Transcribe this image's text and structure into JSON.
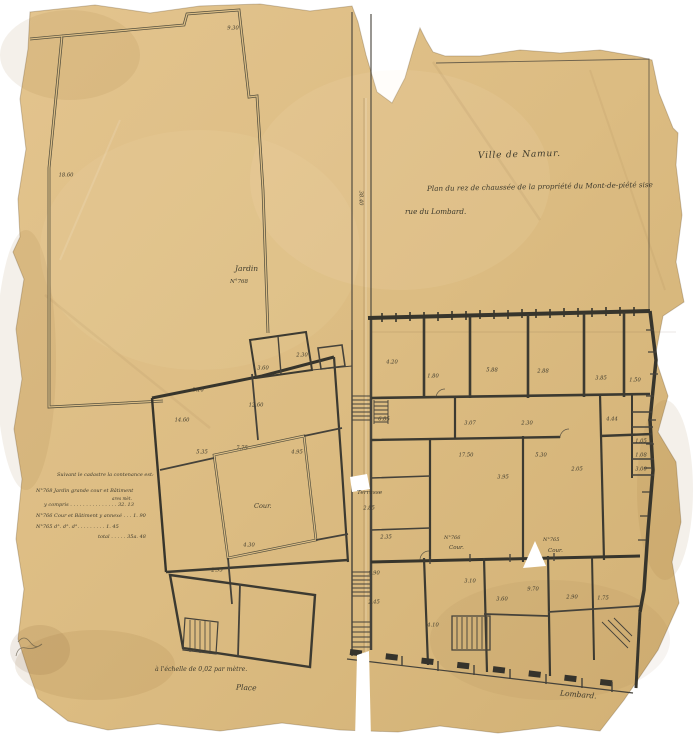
{
  "colors": {
    "paper": "#dcbe86",
    "paper_light": "#e3c48e",
    "paper_dark": "#d2b175",
    "ink": "#45423a",
    "wall": "#37352c",
    "tear_white": "#ffffff"
  },
  "title_block": {
    "line1": "Ville de Namur.",
    "line2": "Plan du rez de chaussée de la propriété du Mont-de-piété sise",
    "line3": "rue du Lombard."
  },
  "cadastre": {
    "heading": "Suivant le cadastre la contenance est:",
    "col_header": "ares mèt.",
    "rows": [
      "N°768 Jardin grande cour et Bâtiment",
      "y compris . . . . . . . . . . . . . . .   32. 13",
      "N°766 Cour et Bâtiment y annexé . . .   1. 90",
      "N°765  d°.   d°.   d°.  . . . . . . . .   1. 45"
    ],
    "total": "total . . . . .  35a. 48"
  },
  "labels": {
    "jardin": "Jardin",
    "jardin_no": "N°768",
    "terrasse": "Terrasse",
    "cour_left": "Cour.",
    "cour_766_no": "N°766",
    "cour_766": "Cour.",
    "cour_765_no": "N°765",
    "cour_765": "Cour.",
    "scale_note": "à l'échelle de 0,02 par mètre.",
    "street_place": "Place",
    "street_lombard": "Lombard."
  },
  "plan": {
    "dimensions": [
      {
        "x": 233,
        "y": 29,
        "t": "9.30"
      },
      {
        "x": 66,
        "y": 176,
        "t": "18.60"
      },
      {
        "x": 360,
        "y": 198,
        "t": "38.40",
        "r": 90
      },
      {
        "x": 392,
        "y": 363,
        "t": "4.20"
      },
      {
        "x": 433,
        "y": 377,
        "t": "1.80"
      },
      {
        "x": 492,
        "y": 371,
        "t": "5.88"
      },
      {
        "x": 543,
        "y": 372,
        "t": "2.88"
      },
      {
        "x": 601,
        "y": 379,
        "t": "3.85"
      },
      {
        "x": 635,
        "y": 381,
        "t": "1.50"
      },
      {
        "x": 470,
        "y": 424,
        "t": "3.07"
      },
      {
        "x": 527,
        "y": 424,
        "t": "2.30"
      },
      {
        "x": 612,
        "y": 420,
        "t": "4.44"
      },
      {
        "x": 641,
        "y": 442,
        "t": "1.05"
      },
      {
        "x": 641,
        "y": 456,
        "t": "1.08"
      },
      {
        "x": 641,
        "y": 470,
        "t": "3.00"
      },
      {
        "x": 466,
        "y": 456,
        "t": "17.50"
      },
      {
        "x": 541,
        "y": 456,
        "t": "5.30"
      },
      {
        "x": 503,
        "y": 478,
        "t": "3.95"
      },
      {
        "x": 577,
        "y": 470,
        "t": "2.05"
      },
      {
        "x": 384,
        "y": 420,
        "t": "6.85"
      },
      {
        "x": 369,
        "y": 509,
        "t": "2.85"
      },
      {
        "x": 386,
        "y": 538,
        "t": "2.35"
      },
      {
        "x": 470,
        "y": 582,
        "t": "3.10"
      },
      {
        "x": 533,
        "y": 590,
        "t": "9.70"
      },
      {
        "x": 433,
        "y": 626,
        "t": "4.10"
      },
      {
        "x": 502,
        "y": 600,
        "t": "3.60"
      },
      {
        "x": 572,
        "y": 598,
        "t": "2.90"
      },
      {
        "x": 603,
        "y": 599,
        "t": "1.75"
      },
      {
        "x": 374,
        "y": 574,
        "t": "1.90"
      },
      {
        "x": 374,
        "y": 603,
        "t": "2.45"
      },
      {
        "x": 198,
        "y": 391,
        "t": "3.10"
      },
      {
        "x": 263,
        "y": 369,
        "t": "3.60"
      },
      {
        "x": 302,
        "y": 356,
        "t": "2.30"
      },
      {
        "x": 182,
        "y": 421,
        "t": "14.60"
      },
      {
        "x": 256,
        "y": 406,
        "t": "12.60"
      },
      {
        "x": 202,
        "y": 453,
        "t": "5.35"
      },
      {
        "x": 242,
        "y": 449,
        "t": "7.75"
      },
      {
        "x": 297,
        "y": 453,
        "t": "4.95"
      },
      {
        "x": 249,
        "y": 546,
        "t": "4.30"
      },
      {
        "x": 217,
        "y": 571,
        "t": "2.95"
      }
    ]
  }
}
